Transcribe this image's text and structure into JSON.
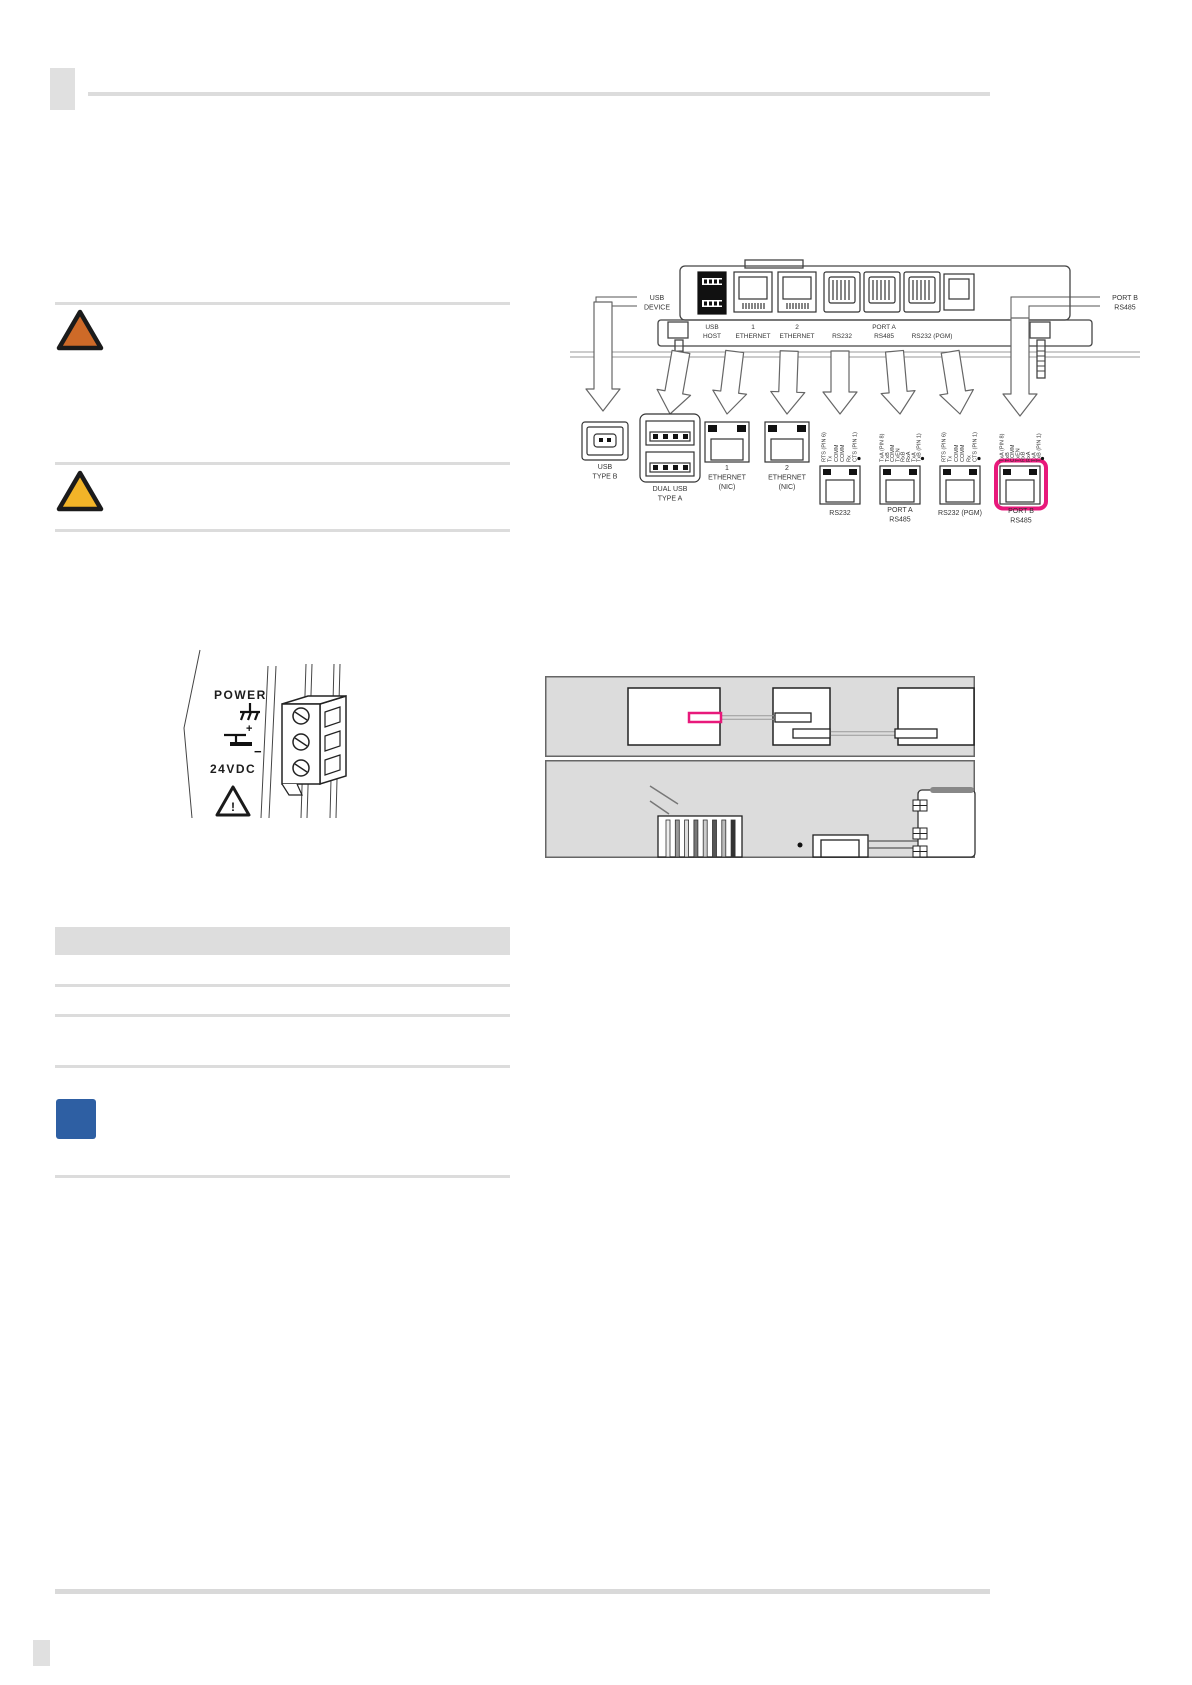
{
  "colors": {
    "highlight_pink": "#E8197B",
    "warning_orange": "#CE6A28",
    "caution_yellow": "#F2B428",
    "note_blue": "#2E5FA3",
    "rule_gray": "#DCDCDC"
  },
  "rear_panel": {
    "usb_device_label": [
      "USB",
      "DEVICE"
    ],
    "port_b_label": [
      "PORT B",
      "RS485"
    ],
    "strip": {
      "usb_host": [
        "USB",
        "HOST"
      ],
      "eth1": [
        "1",
        "ETHERNET"
      ],
      "eth2": [
        "2",
        "ETHERNET"
      ],
      "rs232": "RS232",
      "port_a": [
        "PORT A",
        "RS485"
      ],
      "rs232_pgm": "RS232 (PGM)"
    }
  },
  "callouts": {
    "usb_b": [
      "USB",
      "TYPE B"
    ],
    "dual_usb": [
      "DUAL USB",
      "TYPE A"
    ],
    "eth1": [
      "1",
      "ETHERNET",
      "(NIC)"
    ],
    "eth2": [
      "2",
      "ETHERNET",
      "(NIC)"
    ],
    "rs232": "RS232",
    "port_a": [
      "PORT A",
      "RS485"
    ],
    "rs232_pgm": "RS232 (PGM)",
    "port_b": [
      "PORT B",
      "RS485"
    ],
    "rs232_pins": [
      "RTS (PIN 6)",
      "Tx",
      "COMM",
      "COMM",
      "Rx",
      "CTS (PIN 1)"
    ],
    "rs485_pins": [
      "TxA (PIN 8)",
      "TxB",
      "COMM",
      "TxEN",
      "RxB",
      "RxA",
      "TxA",
      "TxB (PIN 1)"
    ]
  },
  "power": {
    "title": "POWER",
    "voltage": "24VDC",
    "plus": "+",
    "minus": "−",
    "exclamation": "!"
  }
}
